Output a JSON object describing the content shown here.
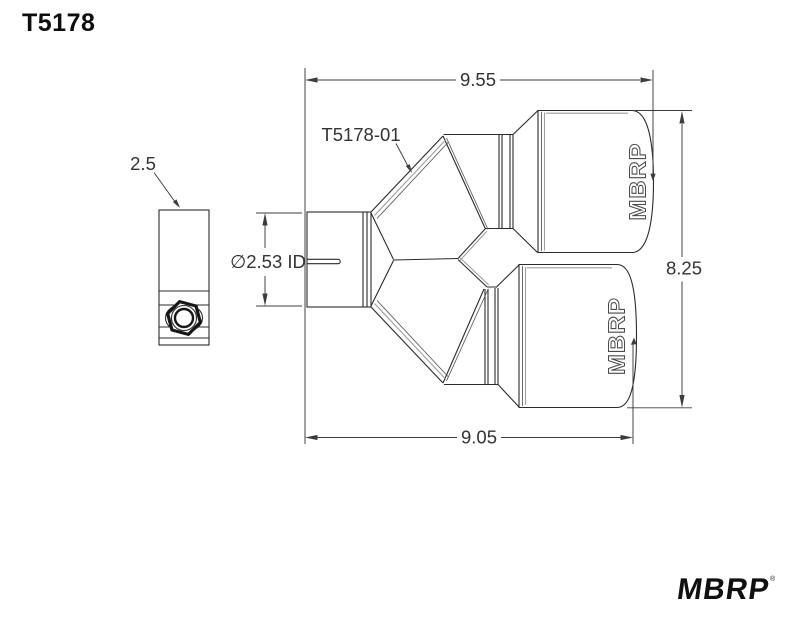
{
  "page": {
    "title": "T5178",
    "background": "#ffffff"
  },
  "drawing": {
    "part_label": "T5178-01",
    "dimensions": {
      "top_width": "9.55",
      "bottom_width": "9.05",
      "overall_height": "8.25",
      "inlet_diameter": "∅2.53 ID",
      "clamp_size": "2.5"
    },
    "tip_logo_text": "MBRP",
    "colors": {
      "line": "#2b2b2b",
      "seam": "#9e9e9e",
      "dim": "#3c3c3c",
      "text": "#333333"
    }
  },
  "footer": {
    "brand_logo": "MBRP",
    "trademark_symbol": "®"
  }
}
